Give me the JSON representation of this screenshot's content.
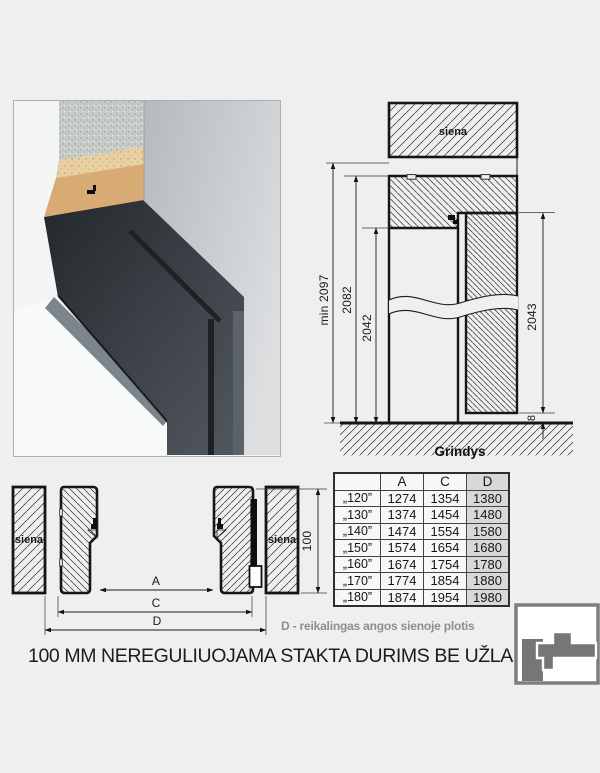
{
  "elevation": {
    "wall_label": "siena",
    "floor_label": "Grindys",
    "dims": {
      "min_total": "min 2097",
      "frame": "2082",
      "opening": "2042",
      "leaf": "2043",
      "gap": "8"
    }
  },
  "plan": {
    "wall_left": "siena",
    "wall_right": "siena",
    "dims": {
      "a": "A",
      "c": "C",
      "d": "D",
      "depth": "100"
    }
  },
  "table": {
    "headers": [
      "",
      "A",
      "C",
      "D"
    ],
    "rows": [
      [
        "„120”",
        "1274",
        "1354",
        "1380"
      ],
      [
        "„130”",
        "1374",
        "1454",
        "1480"
      ],
      [
        "„140”",
        "1474",
        "1554",
        "1580"
      ],
      [
        "„150”",
        "1574",
        "1654",
        "1680"
      ],
      [
        "„160”",
        "1674",
        "1754",
        "1780"
      ],
      [
        "„170”",
        "1774",
        "1854",
        "1880"
      ],
      [
        "„180”",
        "1874",
        "1954",
        "1980"
      ]
    ],
    "highlight_color": "#d8d8d8"
  },
  "notes": {
    "d_note": "D - reikalingas angos sienoje plotis",
    "caption": "100 MM NEREGULIUOJAMA STAKTA DURIMS BE UŽLAIDOS"
  },
  "colors": {
    "background": "#efeff0",
    "note_gray": "#8e8e8e",
    "frame_dark": "#32373c",
    "logo_gray": "#767676",
    "line": "#1a1a1a"
  }
}
